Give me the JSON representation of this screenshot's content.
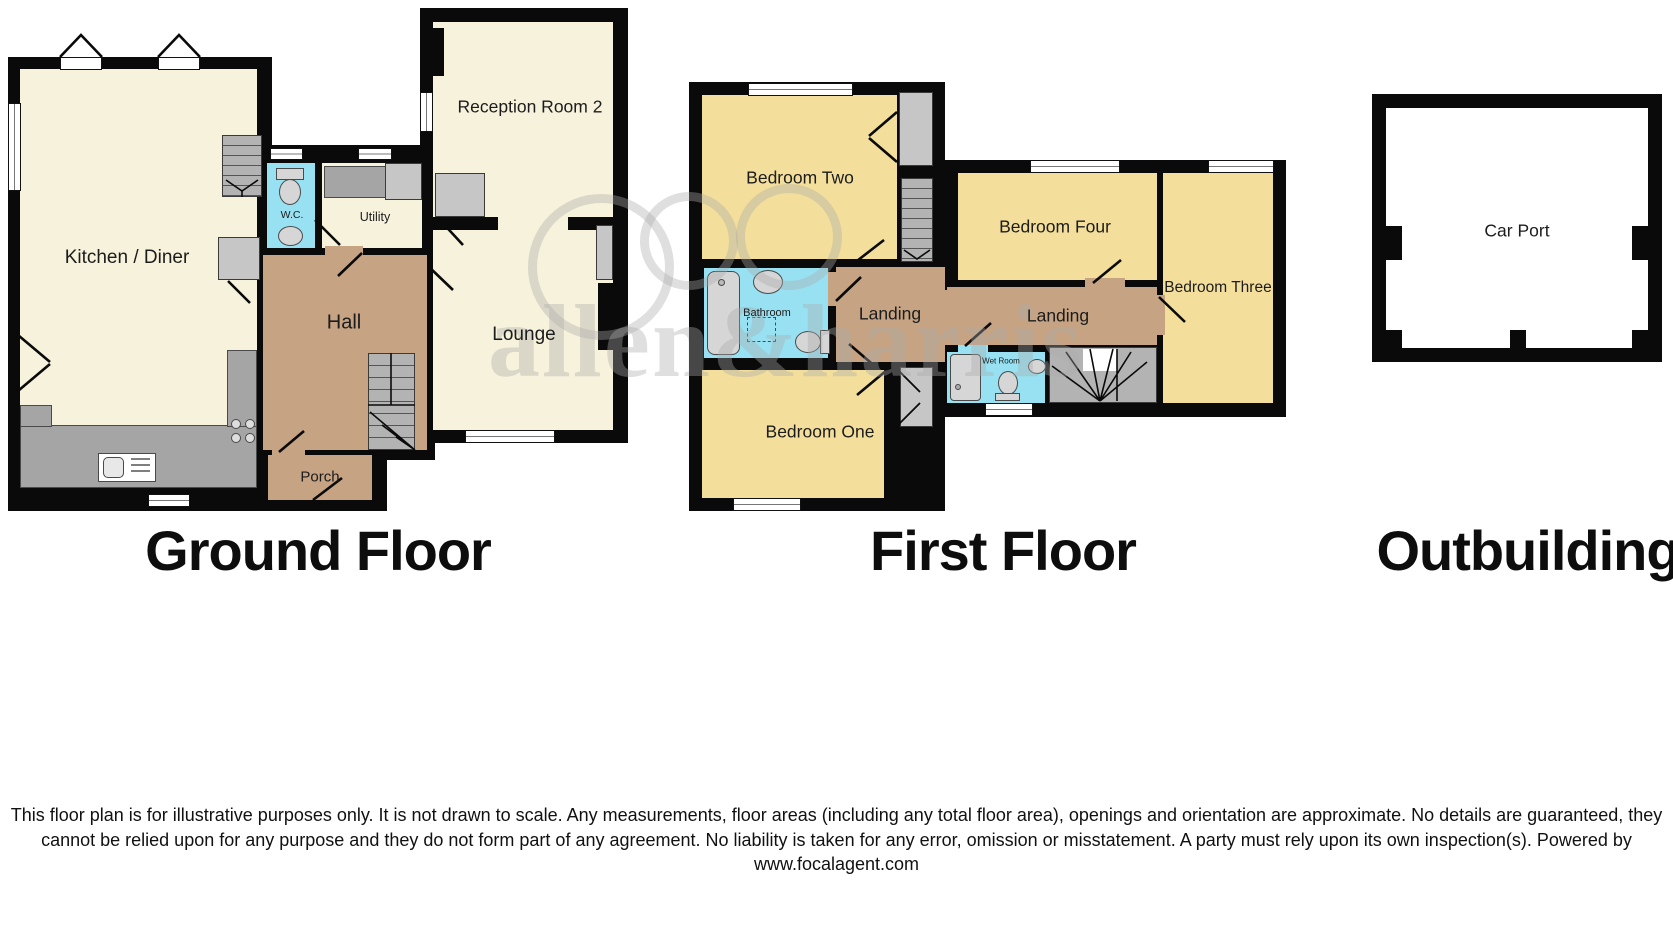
{
  "document_type": "floor-plan",
  "sections": [
    {
      "id": "ground-floor",
      "title": "Ground Floor"
    },
    {
      "id": "first-floor",
      "title": "First Floor"
    },
    {
      "id": "outbuilding",
      "title": "Outbuilding"
    }
  ],
  "rooms": {
    "kitchen_diner": "Kitchen / Diner",
    "wc": "W.C.",
    "utility": "Utility",
    "hall": "Hall",
    "porch": "Porch",
    "reception_room_2": "Reception Room 2",
    "lounge": "Lounge",
    "bedroom_two": "Bedroom Two",
    "bedroom_four": "Bedroom Four",
    "bedroom_three": "Bedroom Three",
    "bedroom_one": "Bedroom One",
    "bathroom": "Bathroom",
    "landing_left": "Landing",
    "landing_right": "Landing",
    "wet_room": "Wet Room",
    "car_port": "Car Port"
  },
  "watermark": {
    "text": "allen&harris"
  },
  "disclaimer": "This floor plan is for illustrative purposes only. It is not drawn to scale. Any measurements, floor areas (including any total floor area), openings and orientation are approximate. No details are guaranteed, they cannot be relied upon for any purpose and they do not form part of any agreement. No liability is taken for any error, omission or misstatement. A party must rely upon its own inspection(s). Powered by www.focalagent.com",
  "colors": {
    "wall": "#0a0a0a",
    "ground_floor_room": "#F7F2DC",
    "first_floor_room": "#F3DF9B",
    "circulation": "#C5A383",
    "wet_area": "#97E1F2",
    "stairs_and_counters": "#B3B3B3",
    "watermark_gray": "#AAAAAA"
  }
}
